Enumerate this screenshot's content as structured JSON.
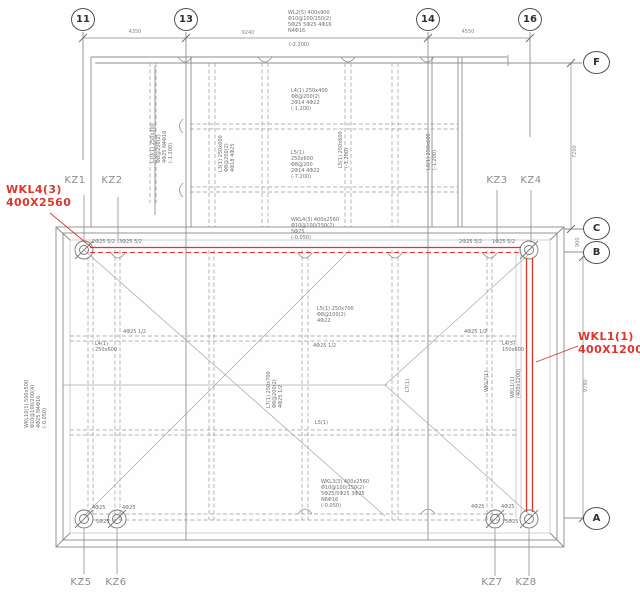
{
  "drawing_type": "structural beam layout plan",
  "colors": {
    "highlight": "#dc372a",
    "line": "#8f8f8f",
    "label": "#8b8b8b"
  },
  "grid": {
    "top": [
      "11",
      "13",
      "14",
      "16"
    ],
    "right": [
      "F",
      "C",
      "B",
      "A"
    ]
  },
  "columns": {
    "top": [
      "KZ1",
      "KZ2",
      "KZ3",
      "KZ4"
    ],
    "bottom": [
      "KZ5",
      "KZ6",
      "KZ7",
      "KZ8"
    ]
  },
  "highlights": {
    "wkl4": "WKL4(3)\n400X2560",
    "wkl1": "WKL1(1)\n400X1200"
  },
  "dimensions": {
    "top_1": "4350",
    "top_2": "9240",
    "top_3": "4550",
    "right_1": "7200",
    "right_2": "900",
    "right_3": "9780"
  },
  "notes": {
    "n01": "WL2(5) 400x900\nΦ10@100/150(2)\n5Φ25 5Φ25 4Φ16\nN4Φ16",
    "n01b": "(-2.200)",
    "n02": "L4(1) 250x400\nΦ8@200(2)\n2Φ14 4Φ22\n(-1.200)",
    "n03": "L5(1)\n250x600\nΦ8@200\n2Φ14 4Φ22\n(-7.200)",
    "n04": "L3(1) 250x600\nΦ8@200(2)\n4Φ18 4Φ25",
    "n05": "L10(1) 250x300\nΦ8@200(2)\n4Φ25 N4Φ16\n(-1.200)",
    "n06": "L5(1) 250x600\n(-1.200)",
    "n07": "L6(1) 250x600\n(-1.200)",
    "n08": "WKL4(3) 400x2560\nΦ10@100/150(2)\n5Φ25\n(-0.050)",
    "n09": "WKL3(3) 400x2560\nΦ10@100/150(2)\n5Φ25/5Φ25 3Φ25\nN6Φ16\n(-0.050)",
    "n10": "L5(1) 250x700\nΦ8@100(2)\n4Φ22",
    "n11": "4Φ25 1/2",
    "n12": "L4(1)\n250x600",
    "n13": "4Φ25 1/2",
    "n14": "L7(1) 250x700\nΦ8@200(2)\n4Φ25 1/2",
    "n15": "WKL10(1) 500x500\nΦ10@100/200(4)\n4Φ25 N4Φ16\n(-0.050)",
    "n16": "WKL7(1)",
    "n17": "WKL1(1)\n(400x1200)",
    "n18": "L7(1)",
    "n19": "2Φ25 5/2",
    "n20": "3Φ25 5/2",
    "n21": "2Φ25 5/2",
    "n22": "1Φ25 5/2",
    "n23": "4Φ25 1/2",
    "n24": "L4(5)\n150x600",
    "n25": "4Φ25",
    "n26": "4Φ25",
    "n27": "5Φ25",
    "n28": "4Φ25",
    "n29": "4Φ25",
    "n30": "5Φ25",
    "n31": "L5(1)"
  }
}
